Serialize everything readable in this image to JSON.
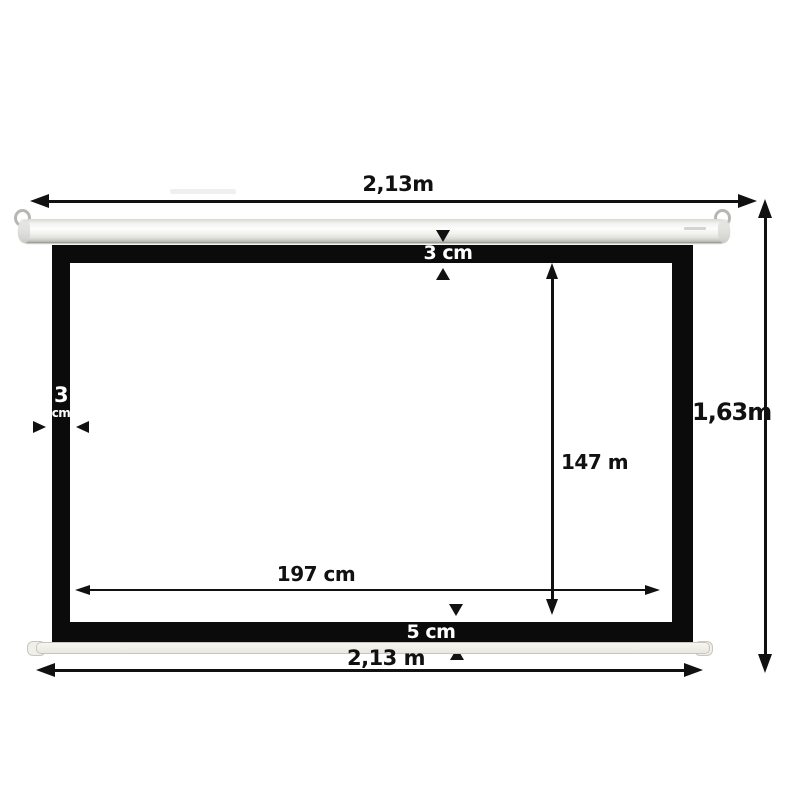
{
  "diagram": {
    "top": {
      "width_label": "2,13m"
    },
    "right": {
      "height_label": "1,63m"
    },
    "borders": {
      "top_label": "3 cm",
      "left_value": "3",
      "left_unit": "cm",
      "bottom_label": "5 cm"
    },
    "inner": {
      "height_label": "147 m",
      "width_label": "197 cm"
    },
    "bottom": {
      "width_label": "2,13 m"
    },
    "colors": {
      "frame": "#0b0b0b",
      "screen": "#ffffff",
      "arrow": "#111111",
      "slat": "#edece4",
      "housing_edge": "#bdbdb7"
    }
  }
}
